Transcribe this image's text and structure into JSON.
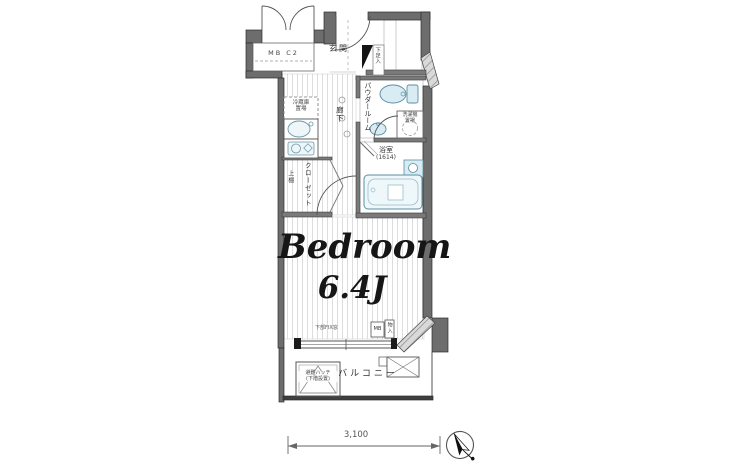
{
  "floorplan": {
    "bedroom": {
      "name": "Bedroom",
      "size": "6.4J"
    },
    "labels": {
      "meter_box": "MB C2",
      "entrance": "玄関",
      "shoe_cabinet": "下足入",
      "fridge_l1": "冷蔵庫",
      "fridge_l2": "置場",
      "corridor": "廊下",
      "powder_room": "パウダールーム",
      "washer_l1": "洗濯機",
      "washer_l2": "置場",
      "bathroom": "浴室",
      "bathroom_size": "(1614)",
      "closet_shelf": "上棚",
      "closet": "クローゼット",
      "window_note": "下部FIX窓",
      "meter_box_2": "MB",
      "storage": "物入",
      "hatch_l1": "避難ハッチ",
      "hatch_l2": "(下階設置)",
      "balcony": "バルコニー"
    },
    "dimension": "3,100",
    "colors": {
      "wall": "#6d6d6d",
      "wall_dark": "#3f3f3f",
      "fixture_fill": "#d9ecf3",
      "floor_stripe": "#dddddd",
      "line": "#555555"
    }
  }
}
